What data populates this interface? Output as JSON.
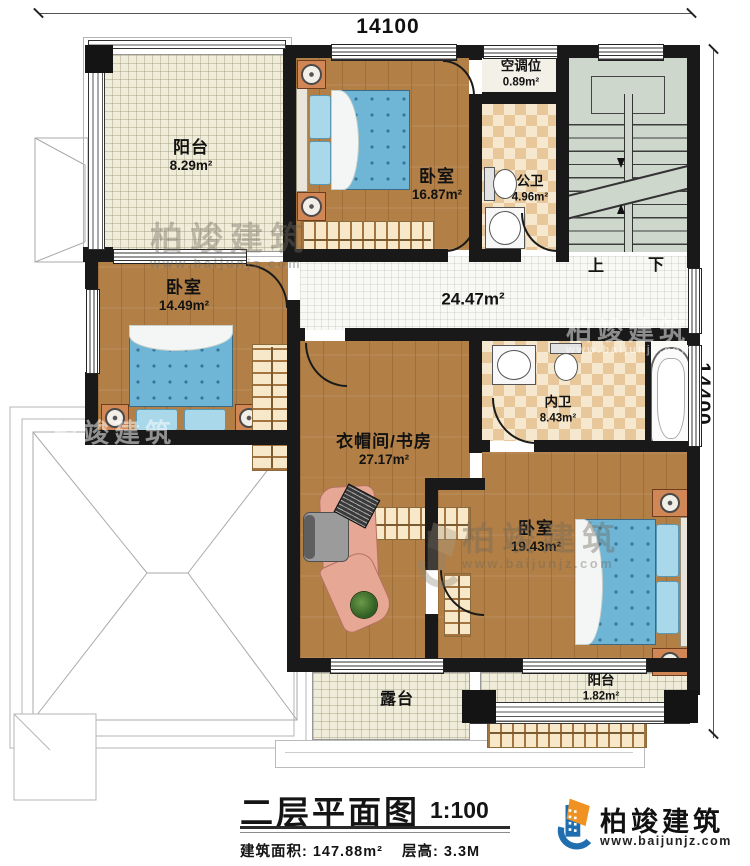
{
  "dimensions": {
    "width_label": "14100",
    "height_label": "14400"
  },
  "rooms": {
    "balcony_tl": {
      "name": "阳台",
      "area": "8.29m²"
    },
    "bedroom_top": {
      "name": "卧室",
      "area": "16.87m²"
    },
    "ac_slot": {
      "name": "空调位",
      "area": "0.89m²"
    },
    "public_bath": {
      "name": "公卫",
      "area": "4.96m²"
    },
    "bedroom_left": {
      "name": "卧室",
      "area": "14.49m²"
    },
    "hallway": {
      "area": "24.47m²"
    },
    "cloakroom_study": {
      "name": "衣帽间/书房",
      "area": "27.17m²"
    },
    "inner_bath": {
      "name": "内卫",
      "area": "8.43m²"
    },
    "bedroom_br": {
      "name": "卧室",
      "area": "19.43m²"
    },
    "terrace": {
      "name": "露台"
    },
    "balcony_br": {
      "name": "阳台",
      "area": "1.82m²"
    }
  },
  "stairs": {
    "up": "上",
    "down": "下"
  },
  "title_block": {
    "title": "二层平面图",
    "scale": "1:100",
    "build_area": "建筑面积: 147.88m²",
    "floor_height": "层高: 3.3M"
  },
  "brand": {
    "name": "柏竣建筑",
    "website": "www.baijunjz.com"
  },
  "watermark": {
    "name": "柏竣建筑",
    "website": "www.baijunjz.com"
  },
  "colors": {
    "wall": "#191919",
    "wood_floor": "#b28047",
    "tile_floor": "#efecd9",
    "bath_tile": "#e8c89b",
    "stair_floor": "#cdd7cc",
    "bed_blue": "#6fb6d6",
    "brand_blue": "#1f6fb0",
    "brand_orange": "#f09221"
  }
}
